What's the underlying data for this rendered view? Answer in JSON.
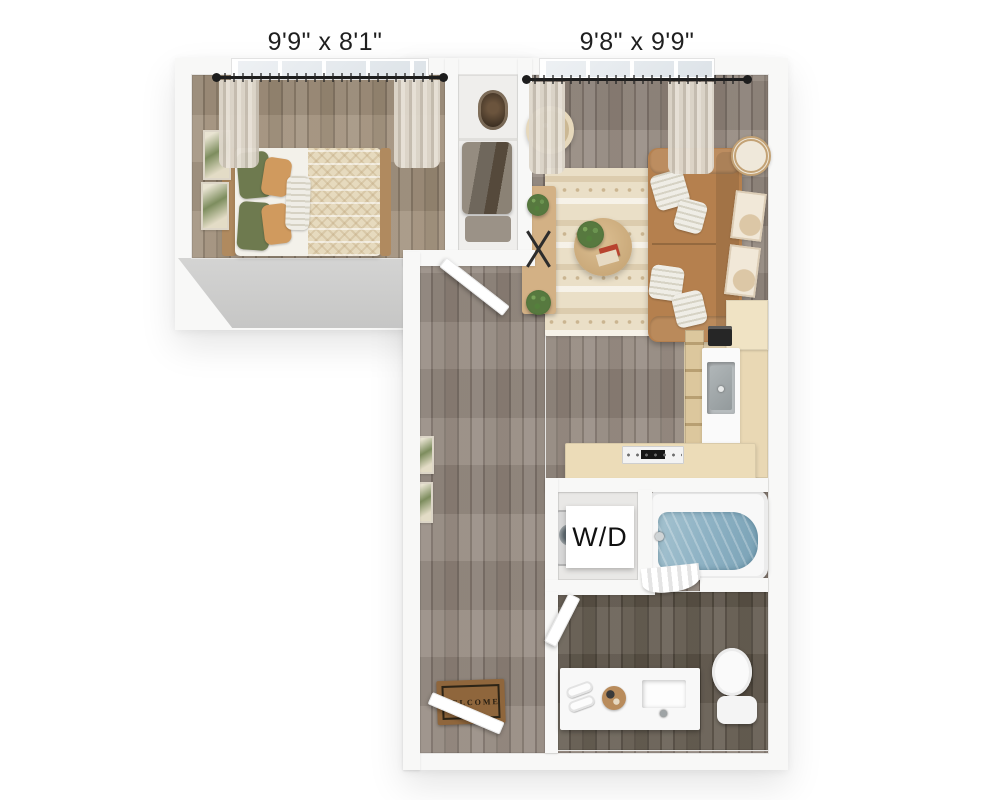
{
  "labels": {
    "bedroom_dimensions": "9'9\" x 8'1\"",
    "living_room_dimensions": "9'8\" x 9'9\"",
    "laundry": "W/D",
    "welcome_mat": "WELCOME"
  },
  "colors": {
    "wall": "#f8f8f7",
    "wall_face_shadow": "#c6c6c5",
    "wood_hall": "#90847a",
    "wood_bedroom": "#9d8c77",
    "wood_bathroom": "#5c5347",
    "closet_floor": "#efeeec",
    "kitchen_cabinet": "#e9d8b4",
    "counter_white": "#fafafa",
    "sink_steel": "#b7bcbe",
    "sofa": "#b5804e",
    "rug": "#ead_fc7",
    "pillow_green": "#6e7a4f",
    "pillow_tan": "#d09a5e",
    "bed_linen": "#f3f1ea",
    "duvet": "#e6dabe",
    "wood_furniture": "#d3b185",
    "plant_green": "#57793f",
    "tub_water": "#8fb3c5",
    "mat": "#8f663c",
    "text": "#1f1f1f"
  }
}
